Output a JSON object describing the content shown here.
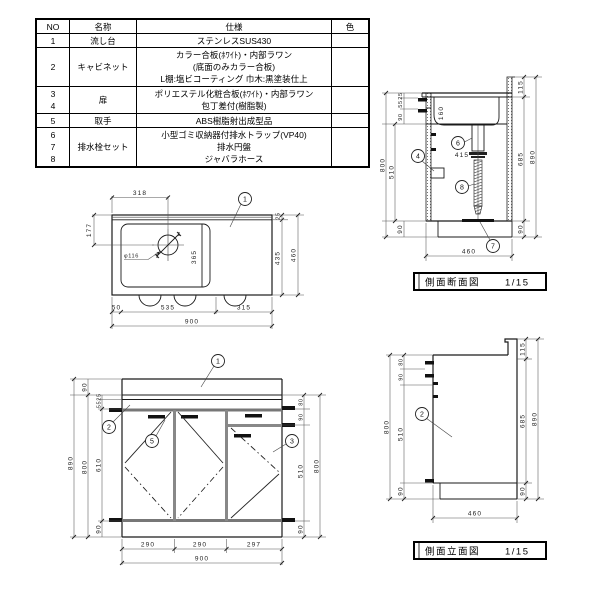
{
  "colors": {
    "line": "#1a1a1a",
    "handle": "#111111",
    "divider": "#888888"
  },
  "table": {
    "h_no": "NO",
    "h_name": "名称",
    "h_spec": "仕様",
    "h_color": "色",
    "r1": {
      "no": "1",
      "name": "流し台",
      "s1": "ステンレスSUS430"
    },
    "r2": {
      "no": "2",
      "name": "キャビネット",
      "s1": "カラー合板(ﾎﾜｲﾄ)・内部ラワン",
      "s2": "(底面のみカラー合板)",
      "s3": "L棚:塩ビコーティング 巾木:黒塗装仕上"
    },
    "r34": {
      "no1": "3",
      "no2": "4",
      "name": "扉",
      "s1": "ポリエステル化粧合板(ﾎﾜｲﾄ)・内部ラワン",
      "s2": "包丁差付(樹脂製)"
    },
    "r5": {
      "no": "5",
      "name": "取手",
      "s1": "ABS樹脂射出成型品"
    },
    "r678": {
      "no1": "6",
      "no2": "7",
      "no3": "8",
      "name": "排水栓セット",
      "s1": "小型ゴミ収納器付排水トラップ(VP40)",
      "s2": "排水円盤",
      "s3": "ジャバラホース"
    }
  },
  "plan": {
    "callout1": "1",
    "d318": "318",
    "d177": "177",
    "d365": "365",
    "drain": "φ116",
    "d25": "25",
    "d435": "435",
    "d460": "460",
    "d50": "50",
    "d535": "535",
    "d315": "315",
    "d900": "900"
  },
  "section": {
    "title": "側面断面図",
    "scale": "1/15",
    "d25": "25",
    "d55": "55",
    "d90top": "90",
    "d800": "800",
    "d510": "510",
    "d90bot": "90",
    "d115": "115",
    "d685": "685",
    "d890": "890",
    "d90r": "90",
    "d160": "160",
    "d415": "415",
    "d460": "460",
    "c4": "4",
    "c6": "6",
    "c7": "7",
    "c8": "8"
  },
  "front": {
    "d90top": "90",
    "d25": "25",
    "d55": "55",
    "d610": "610",
    "d90bot": "90",
    "d800l": "800",
    "d890": "890",
    "d80": "80",
    "d90r": "90",
    "d510": "510",
    "d800r": "800",
    "d90rb": "90",
    "d290a": "290",
    "d290b": "290",
    "d297": "297",
    "d900": "900",
    "c1": "1",
    "c2": "2",
    "c3": "3",
    "c5": "5"
  },
  "elev": {
    "title": "側面立面図",
    "scale": "1/15",
    "d80": "80",
    "d90": "90",
    "d510": "510",
    "d800": "800",
    "d90b": "90",
    "d115": "115",
    "d685": "685",
    "d890": "890",
    "d90r": "90",
    "d460": "460",
    "c2": "2"
  }
}
